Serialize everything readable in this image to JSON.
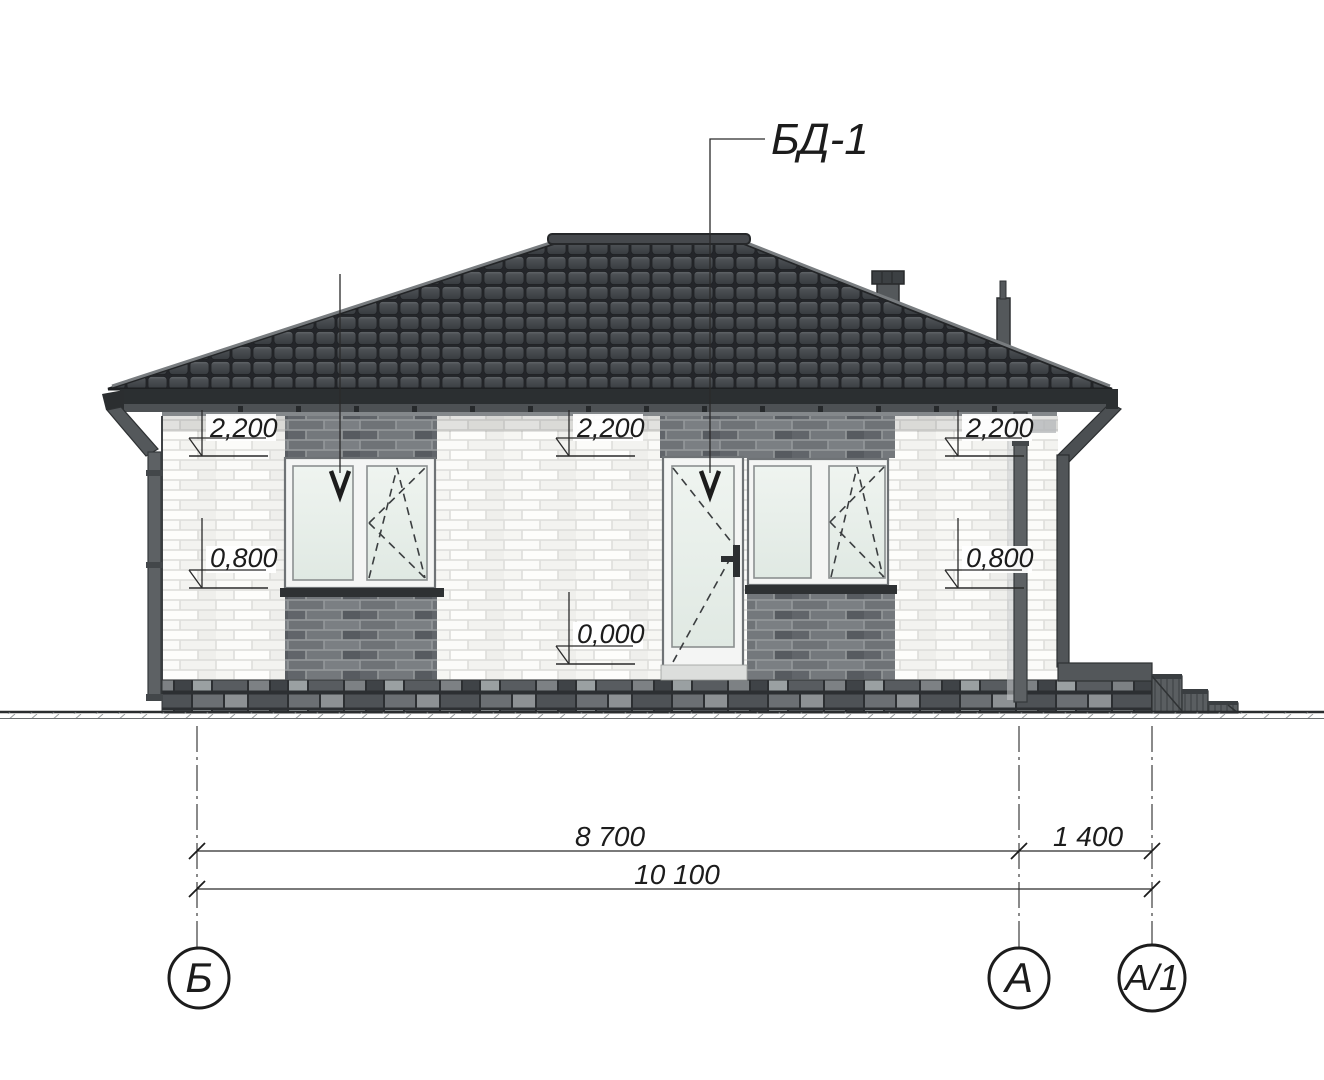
{
  "labels": {
    "door_leader": "БД-1"
  },
  "marks": {
    "left_top": "2,200",
    "left_bottom": "0,800",
    "center_top": "2,200",
    "center_zero": "0,000",
    "right_top": "2,200",
    "right_bottom": "0,800"
  },
  "dims": {
    "wall": "8 700",
    "porch": "1 400",
    "total": "10 100"
  },
  "axes": {
    "b": "Б",
    "a": "А",
    "a1": "А/1"
  },
  "colors": {
    "roof_tile": "#44484c",
    "fascia": "#2b2f31",
    "brick_light": "#fbfbf9",
    "brick_dark": "#6f7377",
    "glass": "#e9efe9",
    "plinth": "#53575a",
    "line": "#1c1c1c"
  }
}
